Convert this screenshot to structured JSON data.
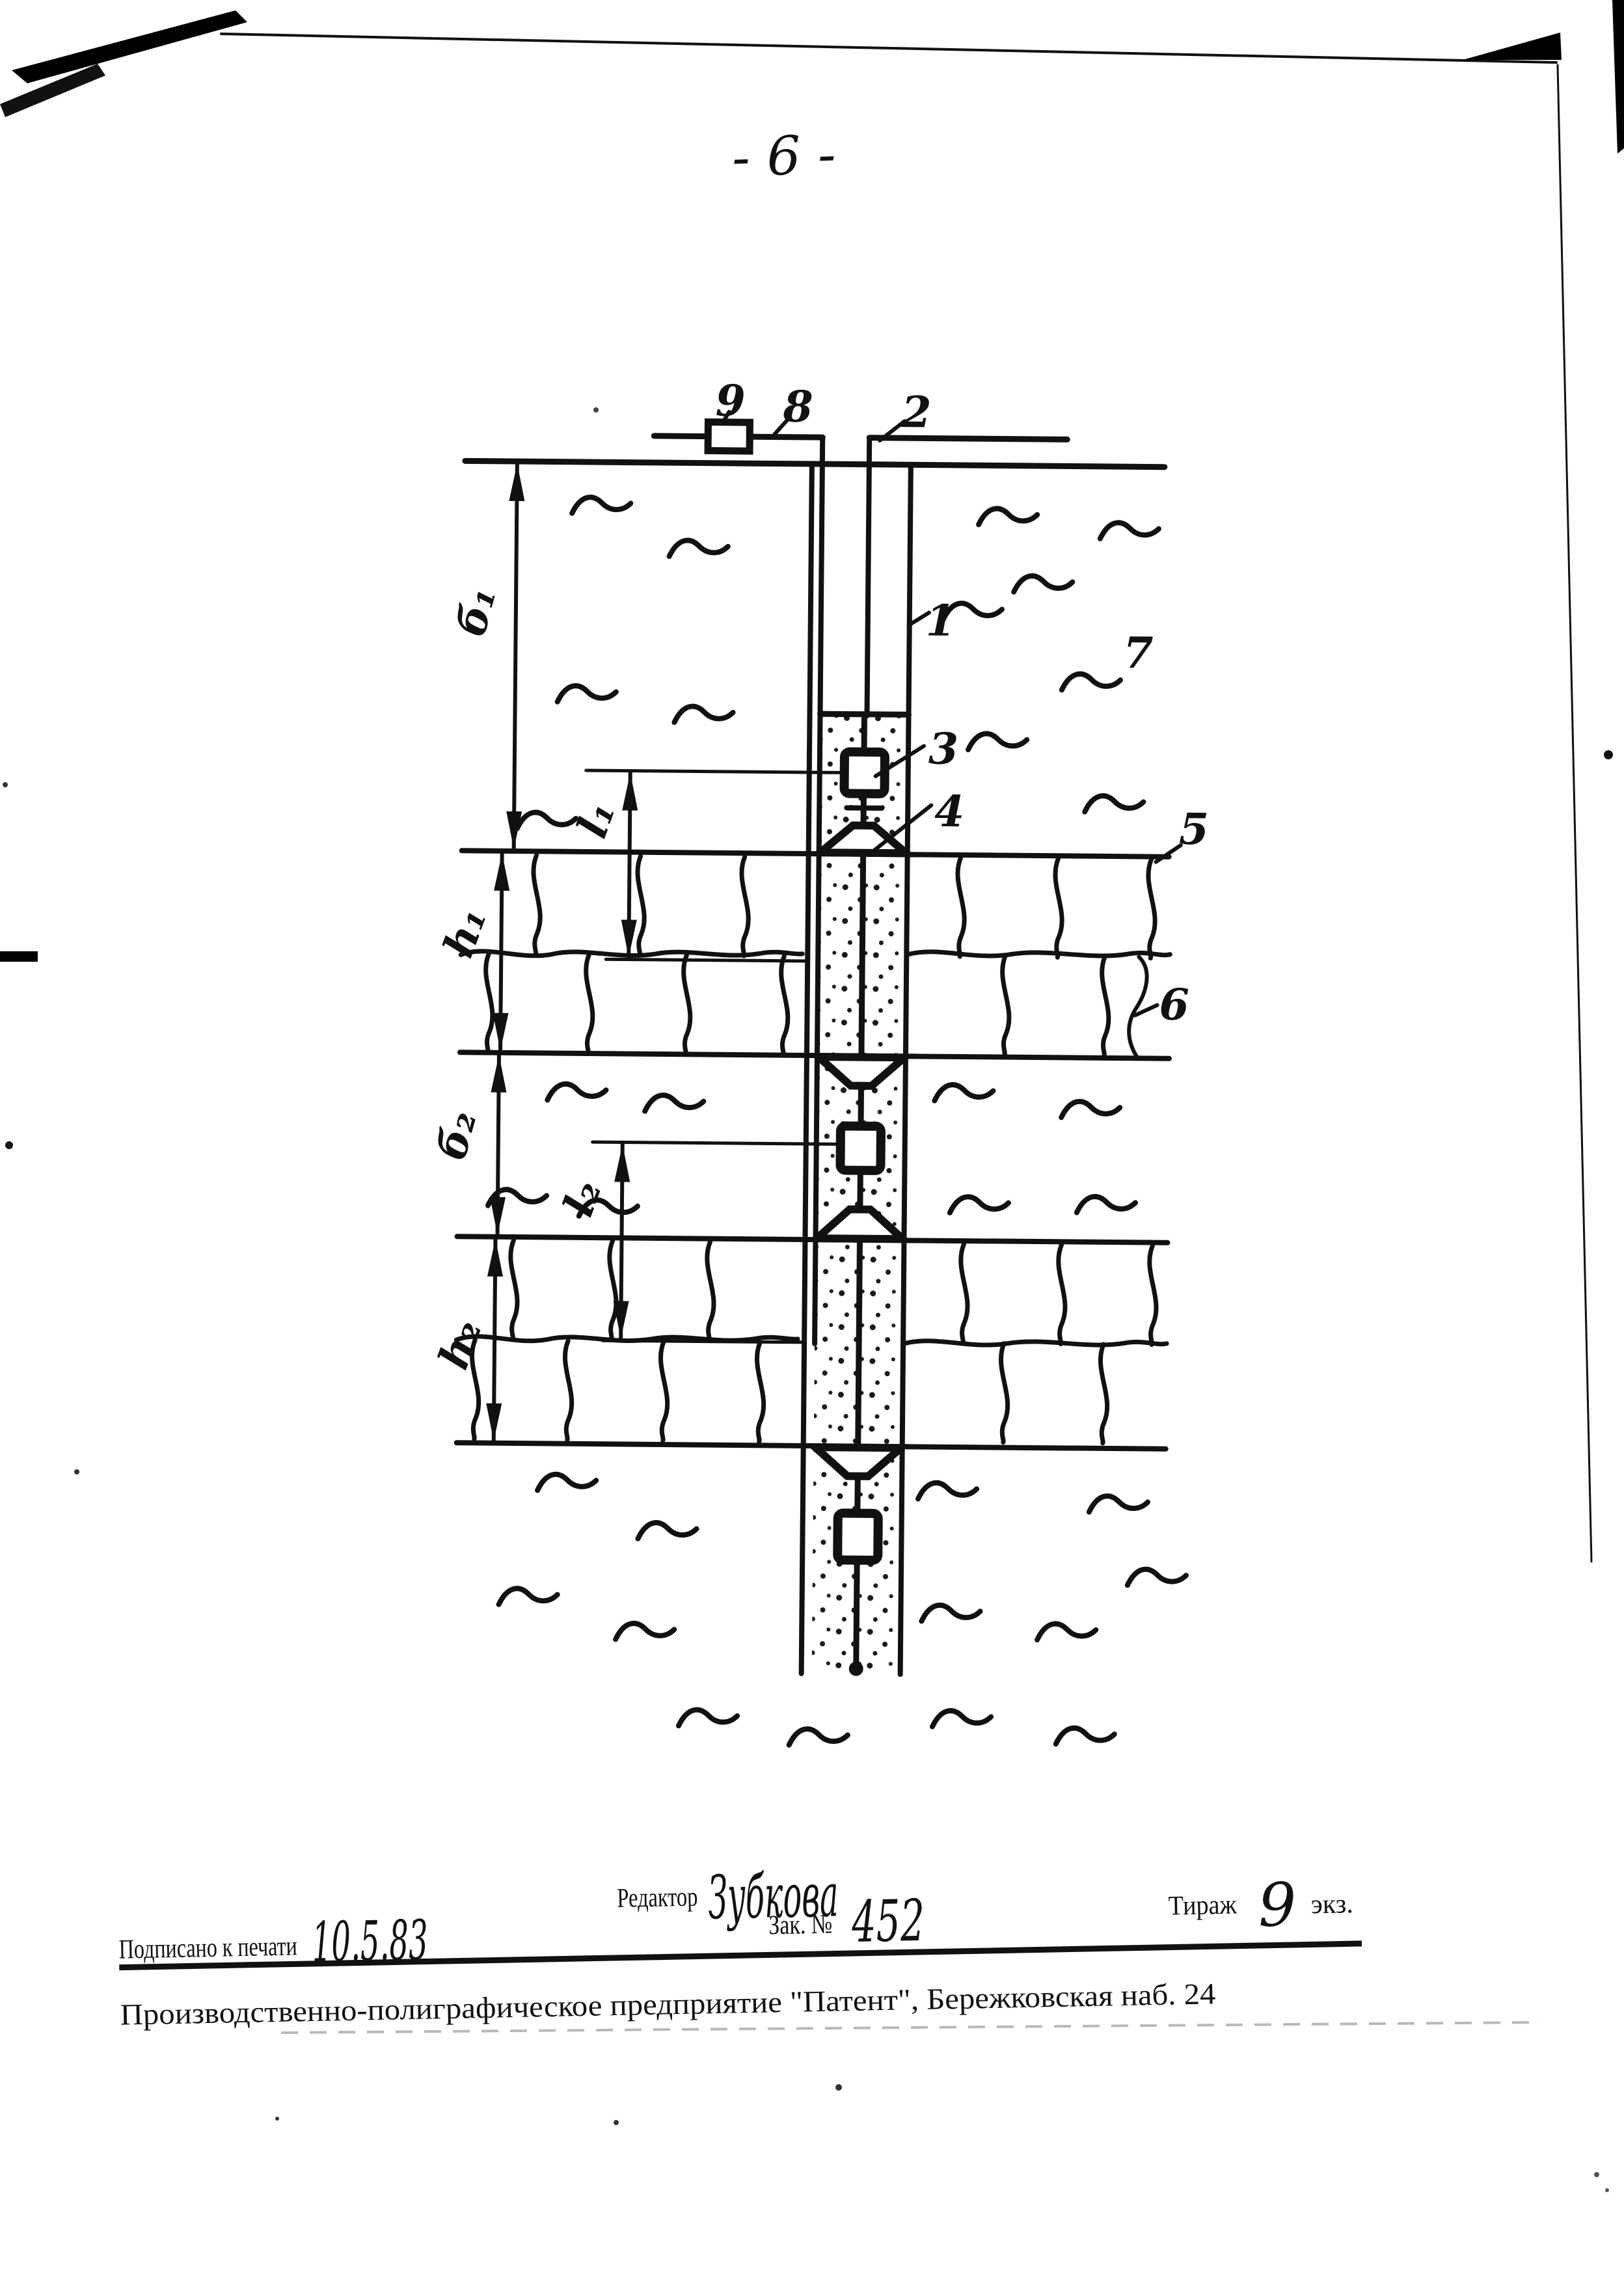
{
  "page": {
    "number": "- 6 -"
  },
  "figure": {
    "callouts": {
      "c1": "1",
      "c2": "2",
      "c3": "3",
      "c4": "4",
      "c5": "5",
      "c6": "6",
      "c7": "7",
      "c8": "8",
      "c9": "9"
    },
    "dimensions": {
      "b1": "б₁",
      "h1": "h₁",
      "l1": "l₁",
      "b2": "б₂",
      "l2": "l₂",
      "h2": "h₂"
    }
  },
  "imprint": {
    "signed_label": "Подписано к печати",
    "signed_date": "10.5.83",
    "editor_label": "Редактор",
    "editor_name": "Зубкова",
    "order_label": "Зак. №",
    "order_number": "452",
    "print_run_label": "Тираж",
    "print_run_value": "9",
    "print_run_unit": "экз.",
    "publisher_line": "Производственно-полиграфическое предприятие \"Патент\", Бережковская наб. 24"
  }
}
